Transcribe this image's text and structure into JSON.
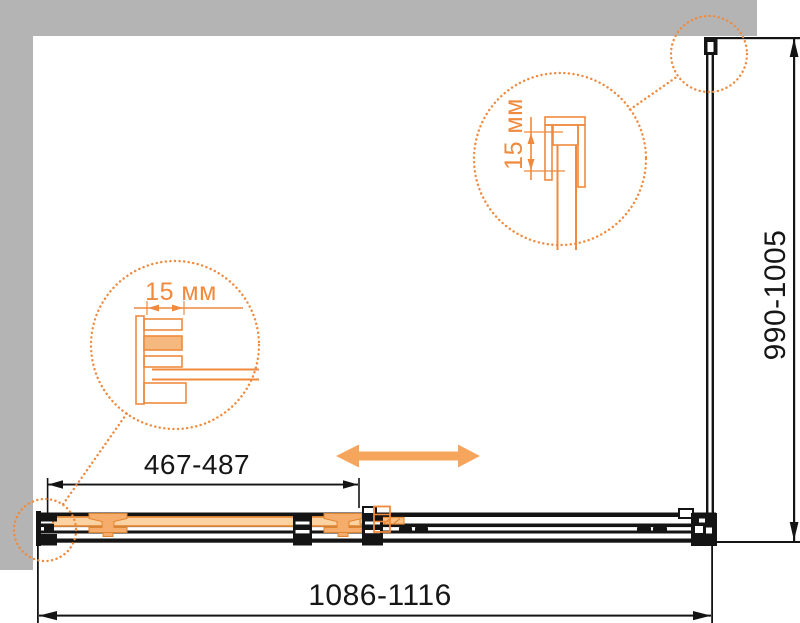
{
  "drawing": {
    "kind": "shower-enclosure-sliding-door-technical-diagram",
    "labels": {
      "overall_width": "1086-1116",
      "height": "990-1005",
      "door_width": "467-487",
      "wall_profile_left": "15 мм",
      "wall_profile_right": "15 мм"
    },
    "icons": {
      "slide_direction": "double-headed-arrow",
      "detail_callouts": "dotted-detail-circles"
    },
    "colors": {
      "accent_orange": "#ef8a3e",
      "arrow_orange": "#f6a55c",
      "panel_orange_fill": "#fbd3a2",
      "line_black": "#141414",
      "border_gray": "#b4b4b4"
    }
  }
}
